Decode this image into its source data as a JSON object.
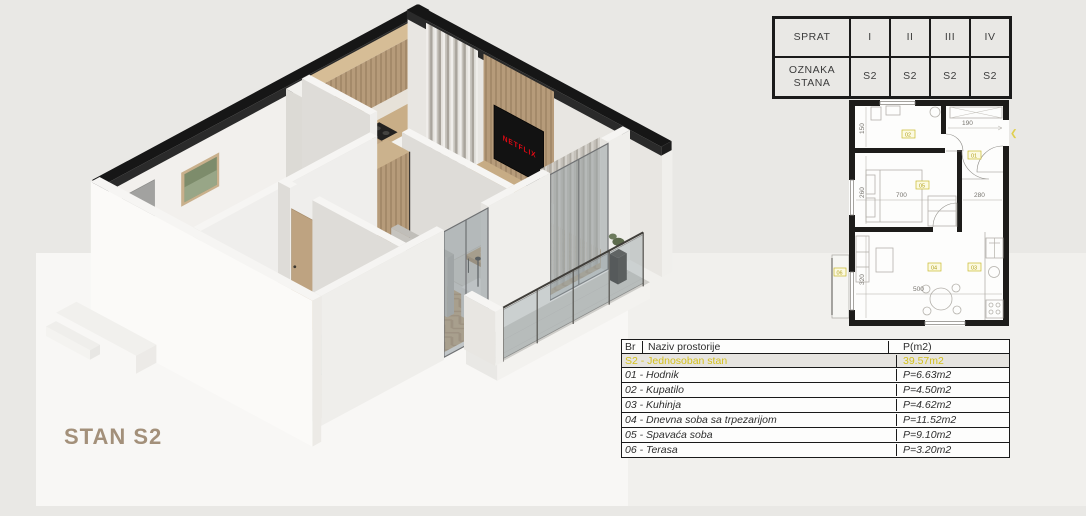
{
  "title": "STAN S2",
  "colors": {
    "accent_yellow": "#d4c11c",
    "netflix_red": "#e50914",
    "title_brown": "#a3907a"
  },
  "floor_table": {
    "rows": [
      {
        "label": "SPRAT",
        "values": [
          "I",
          "II",
          "III",
          "IV"
        ]
      },
      {
        "label": "OZNAKA STANA",
        "values": [
          "S2",
          "S2",
          "S2",
          "S2"
        ]
      }
    ]
  },
  "rooms_table": {
    "col_br": "Br",
    "col_name": "Naziv prostorije",
    "col_area": "P(m2)",
    "highlight": {
      "name": "S2 - Jednosoban stan",
      "area": "39.57m2"
    },
    "rows": [
      {
        "name": "01 - Hodnik",
        "area": "P=6.63m2"
      },
      {
        "name": "02 - Kupatilo",
        "area": "P=4.50m2"
      },
      {
        "name": "03 - Kuhinja",
        "area": "P=4.62m2"
      },
      {
        "name": "04 - Dnevna soba sa trpezarijom",
        "area": "P=11.52m2"
      },
      {
        "name": "05 - Spavaća soba",
        "area": "P=9.10m2"
      },
      {
        "name": "06 - Terasa",
        "area": "P=3.20m2"
      }
    ]
  },
  "plan": {
    "dims": [
      "150",
      "190",
      "260",
      "700",
      "280",
      "320",
      "500"
    ],
    "room_labels": [
      "01",
      "02",
      "03",
      "04",
      "05",
      "06"
    ],
    "entrance_arrow": "❮"
  },
  "scene": {
    "tv_text": "NETFLIX"
  }
}
